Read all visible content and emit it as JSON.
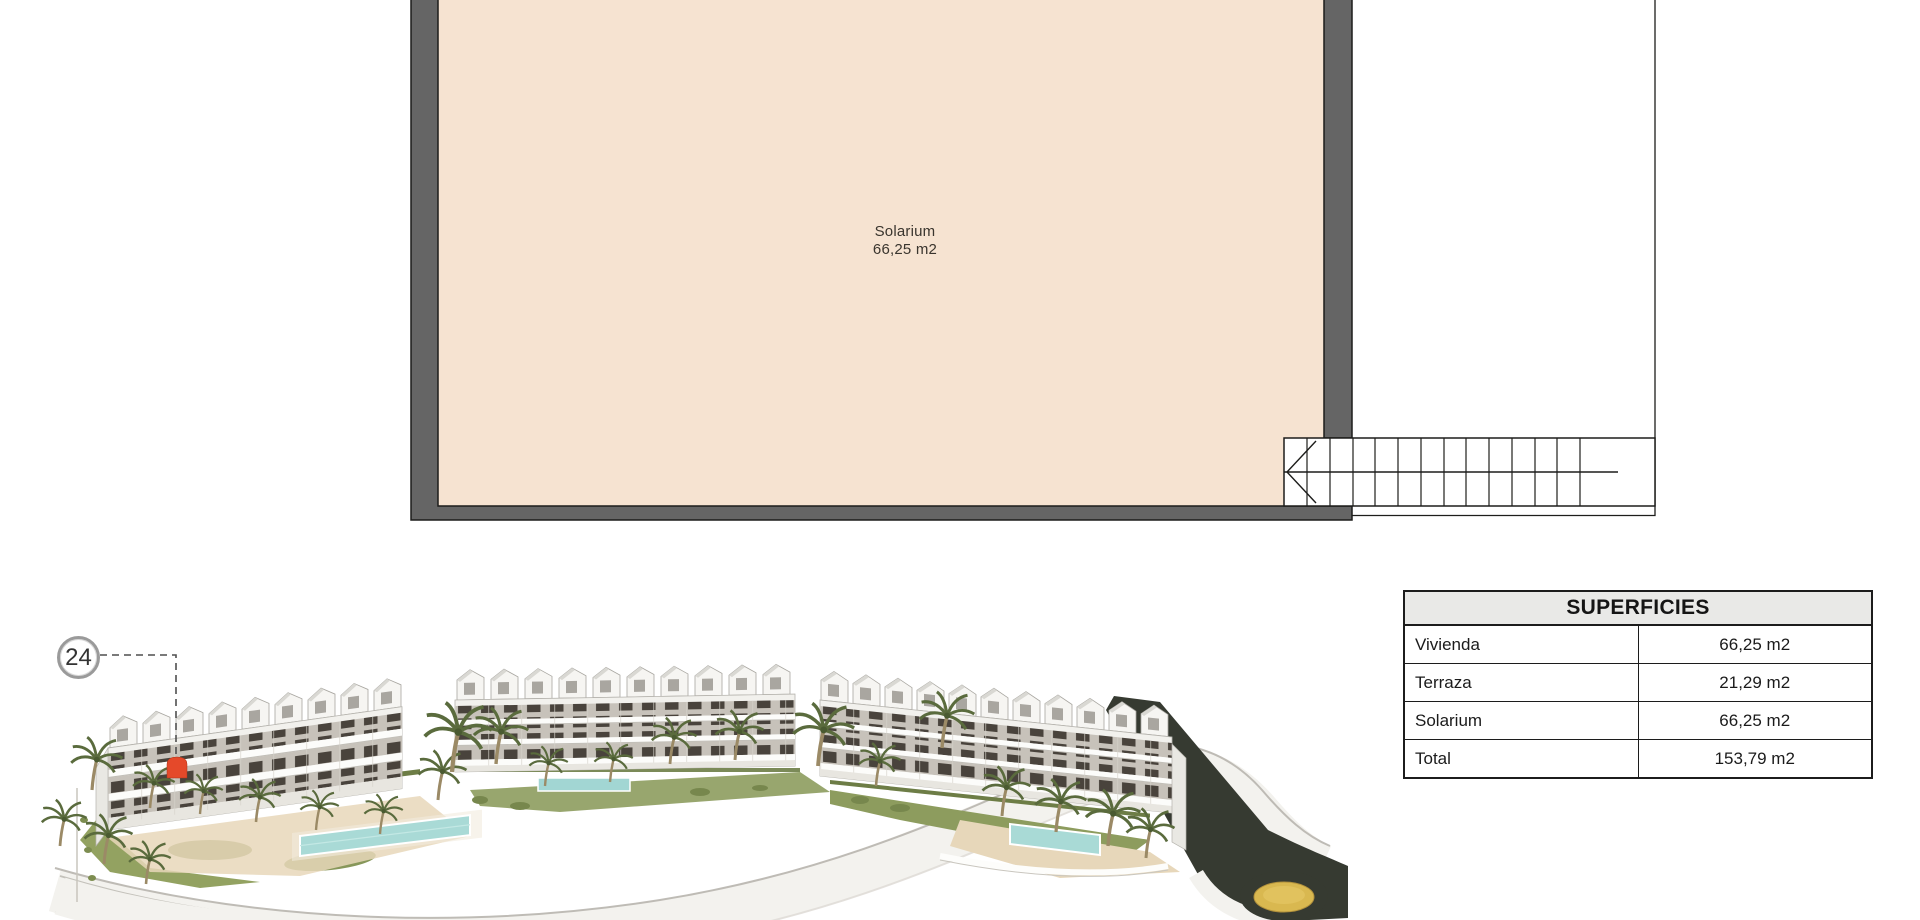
{
  "floor_plan": {
    "room": {
      "label": "Solarium",
      "area": "66,25 m2"
    },
    "fill_color": "#f6e3d1",
    "wall_color": "#656565"
  },
  "unit_marker": {
    "number": "24"
  },
  "areas_table": {
    "title": "SUPERFICIES",
    "rows": [
      {
        "label": "Vivienda",
        "value": "66,25 m2"
      },
      {
        "label": "Terraza",
        "value": "21,29 m2"
      },
      {
        "label": "Solarium",
        "value": "66,25 m2"
      },
      {
        "label": "Total",
        "value": "153,79 m2"
      }
    ]
  },
  "render": {
    "highlight_color": "#e5492a",
    "roundabout_color": "#d9b850",
    "pool_color": "#a9dad6"
  }
}
